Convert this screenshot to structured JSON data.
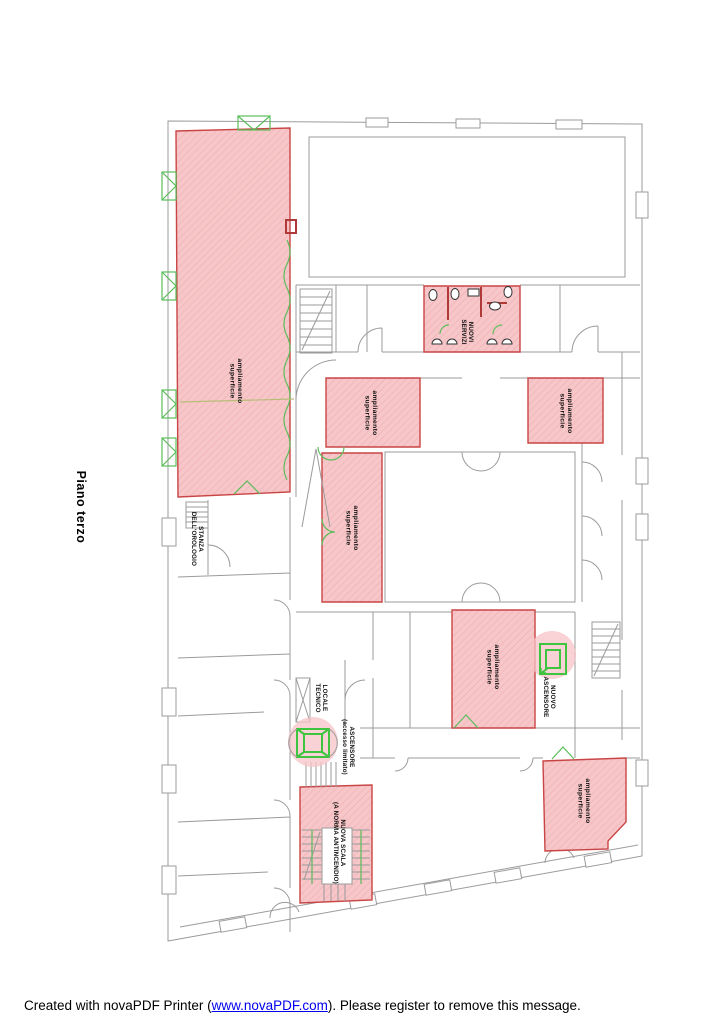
{
  "page": {
    "floor_title": "Piano terzo"
  },
  "footer": {
    "prefix": "Created with novaPDF Printer (",
    "link_text": "www.novaPDF.com",
    "suffix": "). Please register to remove this message."
  },
  "colors": {
    "highlight_fill": "#f6c6c8",
    "highlight_hatch": "#efaeb0",
    "highlight_border": "#c94545",
    "green_element": "#3ec43e",
    "wall_gray": "#9b9b9b",
    "link_blue": "#0000ee"
  },
  "plan": {
    "rooms": [
      {
        "id": "left-wing-large",
        "label": [
          "ampliamento",
          "superficie"
        ]
      },
      {
        "id": "center-upper",
        "label": [
          "ampliamento",
          "superficie"
        ]
      },
      {
        "id": "center-tall",
        "label": [
          "ampliamento",
          "superficie"
        ]
      },
      {
        "id": "east-upper",
        "label": [
          "ampliamento",
          "superficie"
        ]
      },
      {
        "id": "new-services",
        "label": [
          "NUOVI",
          "SERVIZI"
        ]
      },
      {
        "id": "center-lower",
        "label": [
          "ampliamento",
          "superficie"
        ]
      },
      {
        "id": "south-east",
        "label": [
          "ampliamento",
          "superficie"
        ]
      },
      {
        "id": "new-fire-stair",
        "label": [
          "NUOVA SCALA",
          "(A NORMA ANTINCENDIO)"
        ]
      }
    ],
    "annotations": [
      {
        "id": "new-elevator",
        "label": [
          "NUOVO",
          "ASCENSORE"
        ]
      },
      {
        "id": "limited-elevator",
        "label": [
          "ASCENSORE",
          "(accesso limitato)"
        ]
      },
      {
        "id": "clock-room",
        "label": [
          "STANZA",
          "DELL'OROLOGIO"
        ]
      },
      {
        "id": "technical-room",
        "label": [
          "LOCALE",
          "TECNICO"
        ]
      }
    ]
  }
}
